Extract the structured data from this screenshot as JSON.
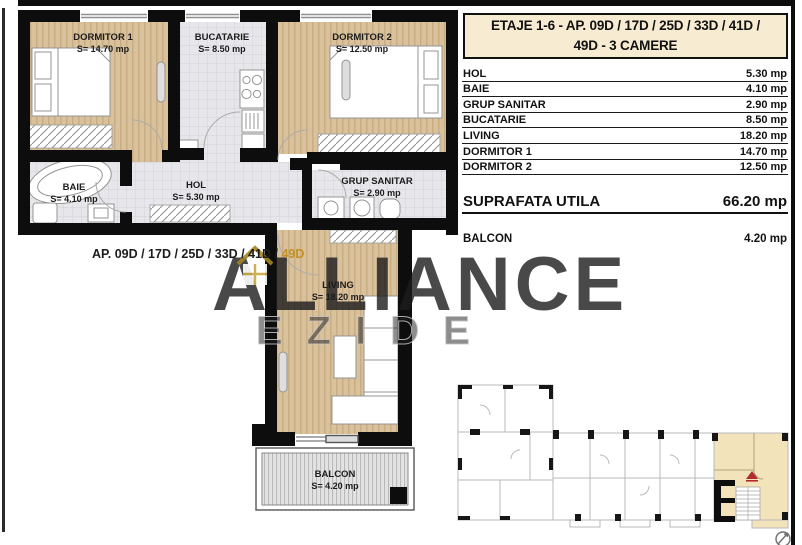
{
  "title": {
    "line1": "ETAJE 1-6 - AP. 09D / 17D / 25D / 33D / 41D /",
    "line2": "49D - 3 CAMERE"
  },
  "area_table": {
    "rows": [
      {
        "label": "HOL",
        "value": "5.30 mp"
      },
      {
        "label": "BAIE",
        "value": "4.10 mp"
      },
      {
        "label": "GRUP SANITAR",
        "value": "2.90 mp"
      },
      {
        "label": "BUCATARIE",
        "value": "8.50 mp"
      },
      {
        "label": "LIVING",
        "value": "18.20 mp"
      },
      {
        "label": "DORMITOR 1",
        "value": "14.70 mp"
      },
      {
        "label": "DORMITOR 2",
        "value": "12.50 mp"
      }
    ],
    "total": {
      "label": "SUPRAFATA UTILA",
      "value": "66.20 mp"
    },
    "balcony": {
      "label": "BALCON",
      "value": "4.20 mp"
    }
  },
  "plan": {
    "rooms": [
      {
        "name": "DORMITOR 1",
        "area": "S= 14.70 mp"
      },
      {
        "name": "BUCATARIE",
        "area": "S= 8.50 mp"
      },
      {
        "name": "DORMITOR 2",
        "area": "S= 12.50 mp"
      },
      {
        "name": "BAIE",
        "area": "S= 4.10 mp"
      },
      {
        "name": "HOL",
        "area": "S= 5.30 mp"
      },
      {
        "name": "GRUP SANITAR",
        "area": "S= 2.90 mp"
      },
      {
        "name": "LIVING",
        "area": "S= 18.20 mp"
      },
      {
        "name": "BALCON",
        "area": "S= 4.20 mp"
      }
    ],
    "ap_label": {
      "prefix": "AP.  09D / 17D / 25D / 33D / 41D / ",
      "highlight": "49D"
    }
  },
  "watermark": {
    "brand": "ALLIANCE",
    "sub": "EZIDE"
  },
  "colors": {
    "accent_gold": "#c49a3c",
    "title_cream": "#f7ecd2",
    "wood_floor": "#d9c19c",
    "tile_floor": "#e7e7eb",
    "highlight_beige": "#f3e3ba",
    "marker_red": "#b2292e"
  }
}
